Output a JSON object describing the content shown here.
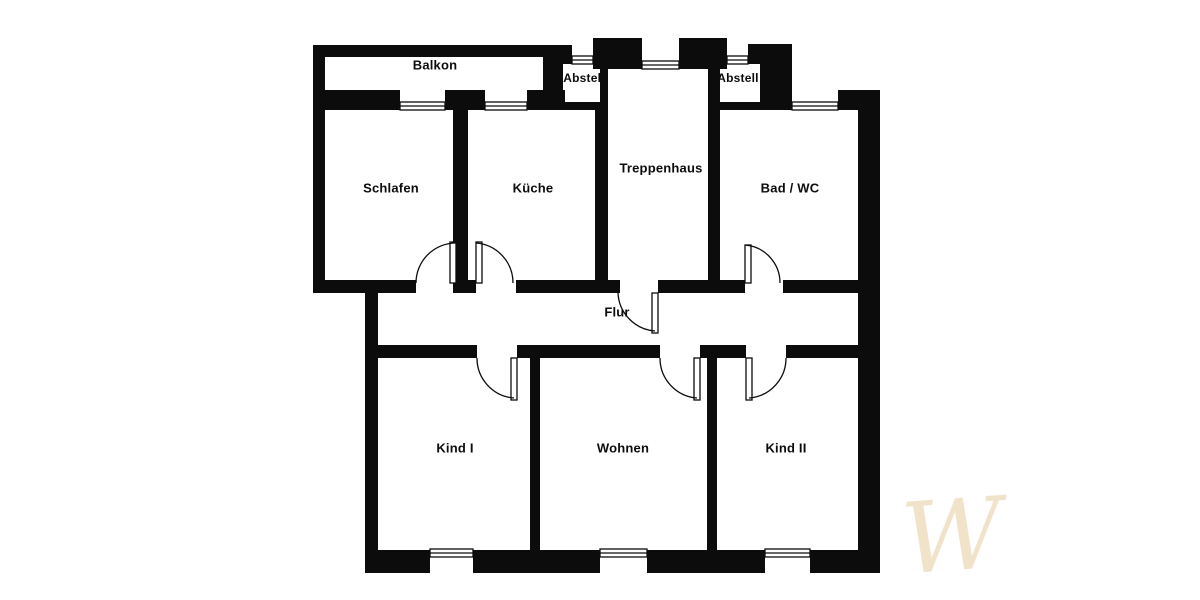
{
  "page": {
    "background": "#ffffff"
  },
  "plan": {
    "wall_color": "#0c0c0c",
    "rooms": {
      "balkon": {
        "label": "Balkon"
      },
      "abstell_left": {
        "label": "Abstell"
      },
      "abstell_right": {
        "label": "Abstell"
      },
      "schlafen": {
        "label": "Schlafen"
      },
      "kueche": {
        "label": "Küche"
      },
      "treppenhaus": {
        "label": "Treppenhaus"
      },
      "bad_wc": {
        "label": "Bad / WC"
      },
      "flur": {
        "label": "Flur"
      },
      "kind_1": {
        "label": "Kind I"
      },
      "wohnen": {
        "label": "Wohnen"
      },
      "kind_2": {
        "label": "Kind II"
      }
    },
    "watermark": {
      "text": "W",
      "color": "#e9d2a8"
    }
  }
}
